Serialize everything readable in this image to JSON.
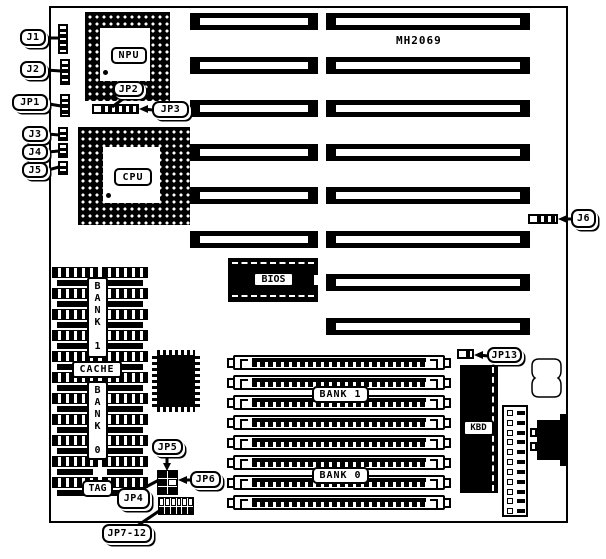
{
  "figure": {
    "board_model": "MH2069"
  },
  "callouts": {
    "j1": "J1",
    "j2": "J2",
    "jp1": "JP1",
    "j3": "J3",
    "j4": "J4",
    "j5": "J5",
    "jp2": "JP2",
    "jp3": "JP3",
    "j6": "J6",
    "jp13": "JP13",
    "jp4": "JP4",
    "jp5": "JP5",
    "jp6": "JP6",
    "jp7_12": "JP7-12"
  },
  "components": {
    "npu": "NPU",
    "cpu": "CPU",
    "bios": "BIOS",
    "kbd": "KBD",
    "cache_label": "CACHE",
    "tag_label": "TAG",
    "cache_bank1_vertical": "B\nA\nN\nK\n\n1",
    "cache_bank0_vertical": "B\nA\nN\nK\n\n0",
    "simm_bank1": "BANK 1",
    "simm_bank0": "BANK 0"
  }
}
